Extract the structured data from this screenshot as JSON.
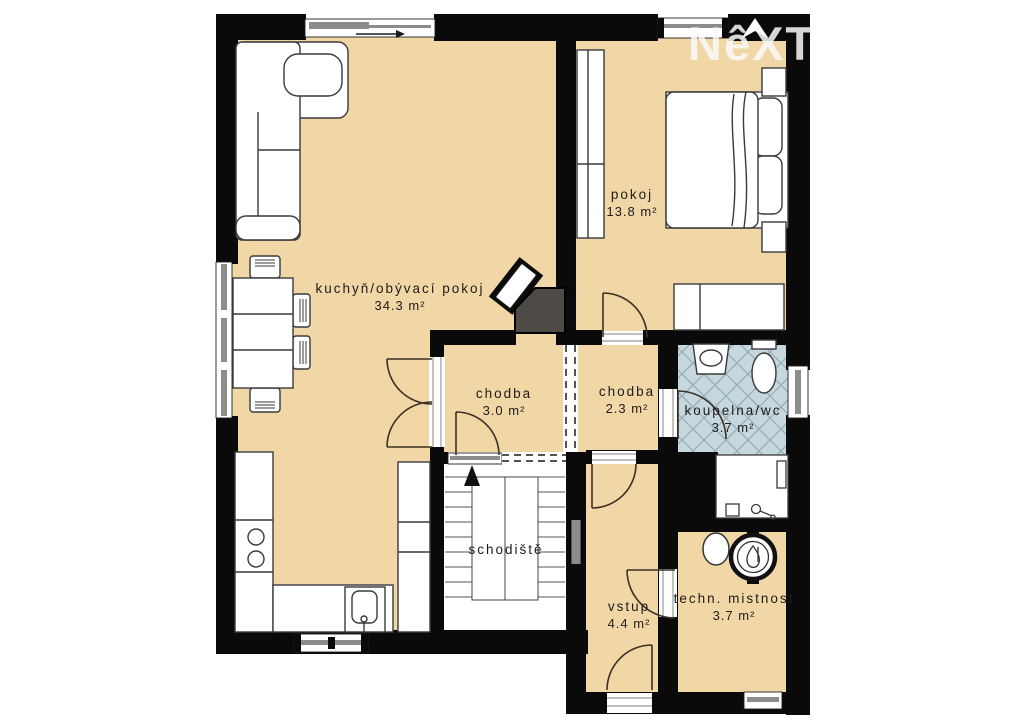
{
  "watermark": {
    "text": "NêXT"
  },
  "colors": {
    "floor": "#f1d6a6",
    "wall": "#0a0a0a",
    "tile": "#c6d7de",
    "tileline": "#94aeba",
    "dark": "#4e4a45",
    "win": "#8c8c8c",
    "line": "#3a3a3a",
    "label": "#1d1d1d",
    "watermark": "rgba(250,250,250,0.85)"
  },
  "rooms": [
    {
      "id": "kitchen-living",
      "name": "kuchyň/obývací pokoj",
      "area": "34.3 m²"
    },
    {
      "id": "bedroom",
      "name": "pokoj",
      "area": "13.8 m²"
    },
    {
      "id": "hallway-1",
      "name": "chodba",
      "area": "3.0 m²"
    },
    {
      "id": "hallway-2",
      "name": "chodba",
      "area": "2.3 m²"
    },
    {
      "id": "bathroom-wc",
      "name": "koupelna/wc",
      "area": "3.7 m²"
    },
    {
      "id": "staircase",
      "name": "schodiště",
      "area": ""
    },
    {
      "id": "entry",
      "name": "vstup",
      "area": "4.4 m²"
    },
    {
      "id": "utility-room",
      "name": "techn. mistnost",
      "area": "3.7 m²"
    }
  ],
  "icons": [
    "north-arrow-icon",
    "stair-direction-arrow-icon",
    "sliding-door-arrow-icon",
    "corner-sofa",
    "dining-table",
    "chair",
    "kitchen-counter",
    "cooktop",
    "kitchen-sink",
    "tall-cabinet",
    "wardrobe",
    "double-bed",
    "nightstand",
    "desk",
    "fireplace-chimney",
    "washbasin",
    "toilet",
    "bathtub",
    "radiator",
    "boiler",
    "water-heater",
    "staircase"
  ]
}
